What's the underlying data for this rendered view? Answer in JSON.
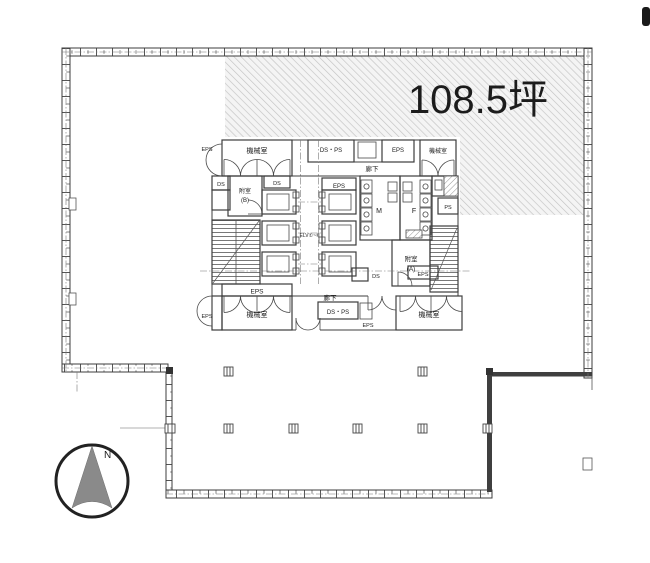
{
  "floorplan": {
    "area_label": "108.5坪",
    "compass_north": "N",
    "colors": {
      "line": "#3c3c3c",
      "hatch_line": "#c3c3c3",
      "hatch_bg": "#f4f4f4",
      "compass_fill": "#8a8a8a"
    },
    "labels": {
      "machine_room": "機械室",
      "corridor": "廊下",
      "eps": "EPS",
      "ds": "DS",
      "ps": "PS",
      "ds_ps": "DS・PS",
      "elevator": "ELV①~⑥",
      "vestibule": "附室",
      "vestibule_a_suffix": "(A)",
      "vestibule_b_suffix": "(B)",
      "toilet_men": "M",
      "toilet_women": "F"
    }
  }
}
